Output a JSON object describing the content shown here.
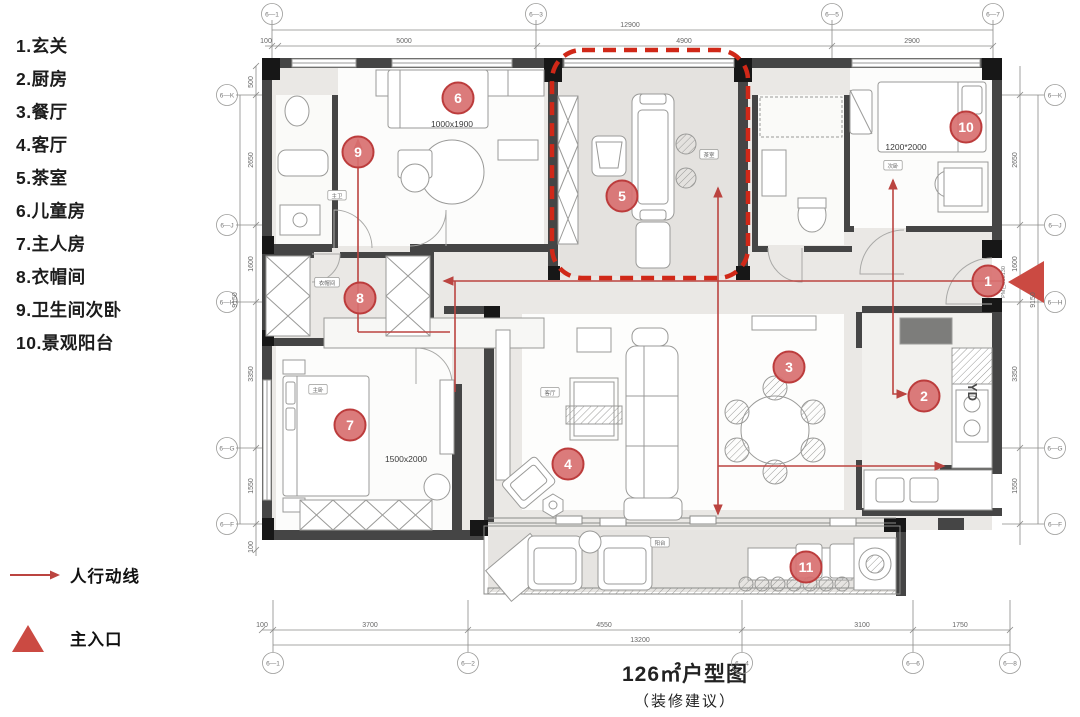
{
  "legend": {
    "items": [
      {
        "num": "1.",
        "label": "玄关"
      },
      {
        "num": "2.",
        "label": "厨房"
      },
      {
        "num": "3.",
        "label": "餐厅"
      },
      {
        "num": "4.",
        "label": "客厅"
      },
      {
        "num": "5.",
        "label": "茶室"
      },
      {
        "num": "6.",
        "label": "儿童房"
      },
      {
        "num": "7.",
        "label": "主人房"
      },
      {
        "num": "8.",
        "label": "衣帽间"
      },
      {
        "num": "9.",
        "label": "卫生间次卧"
      },
      {
        "num": "10.",
        "label": "景观阳台"
      }
    ]
  },
  "flow_legend": {
    "arrow_label": "人行动线",
    "entrance_label": "主入口"
  },
  "title": {
    "main": "126㎡户型图",
    "sub": "（装修建议）"
  },
  "plan": {
    "markers": [
      {
        "n": "1",
        "x": 988,
        "y": 281
      },
      {
        "n": "2",
        "x": 924,
        "y": 396
      },
      {
        "n": "3",
        "x": 789,
        "y": 367
      },
      {
        "n": "4",
        "x": 568,
        "y": 464
      },
      {
        "n": "5",
        "x": 622,
        "y": 196
      },
      {
        "n": "6",
        "x": 458,
        "y": 98
      },
      {
        "n": "7",
        "x": 350,
        "y": 425
      },
      {
        "n": "8",
        "x": 360,
        "y": 298
      },
      {
        "n": "9",
        "x": 358,
        "y": 152
      },
      {
        "n": "10",
        "x": 966,
        "y": 127
      },
      {
        "n": "11",
        "x": 806,
        "y": 567
      }
    ],
    "size_labels": [
      {
        "text": "1000x1900",
        "x": 452,
        "y": 127
      },
      {
        "text": "1200*2000",
        "x": 906,
        "y": 150
      },
      {
        "text": "1500x2000",
        "x": 406,
        "y": 462
      }
    ],
    "room_tags": [
      {
        "text": "主卫",
        "x": 337,
        "y": 197
      },
      {
        "text": "茶室",
        "x": 709,
        "y": 156
      },
      {
        "text": "次卧",
        "x": 893,
        "y": 167
      },
      {
        "text": "衣帽间",
        "x": 327,
        "y": 284
      },
      {
        "text": "主卧",
        "x": 318,
        "y": 391
      },
      {
        "text": "客厅",
        "x": 550,
        "y": 394
      },
      {
        "text": "阳台",
        "x": 660,
        "y": 544
      }
    ],
    "grid": {
      "top": [
        {
          "label": "6-1",
          "x": 272
        },
        {
          "label": "6-3",
          "x": 536
        },
        {
          "label": "6-5",
          "x": 832
        },
        {
          "label": "6-7",
          "x": 993
        }
      ],
      "bottom": [
        {
          "label": "6-1",
          "x": 273
        },
        {
          "label": "6-2",
          "x": 468
        },
        {
          "label": "6-4",
          "x": 742
        },
        {
          "label": "6-6",
          "x": 913
        },
        {
          "label": "6-8",
          "x": 1010
        }
      ],
      "left": [
        {
          "label": "6-K",
          "y": 95
        },
        {
          "label": "6-J",
          "y": 225
        },
        {
          "label": "6-H",
          "y": 302
        },
        {
          "label": "6-G",
          "y": 448
        },
        {
          "label": "6-F",
          "y": 524
        }
      ],
      "right": [
        {
          "label": "6-K",
          "y": 95
        },
        {
          "label": "6-J",
          "y": 225
        },
        {
          "label": "6-H",
          "y": 302
        },
        {
          "label": "6-G",
          "y": 448
        },
        {
          "label": "6-F",
          "y": 524
        }
      ]
    },
    "dims": {
      "top_total": {
        "text": "12900",
        "x": 630,
        "y": 27
      },
      "top_chain": [
        {
          "text": "100",
          "x": 266,
          "y": 43
        },
        {
          "text": "5000",
          "x": 404,
          "y": 43
        },
        {
          "text": "4900",
          "x": 684,
          "y": 43
        },
        {
          "text": "2900",
          "x": 912,
          "y": 43
        }
      ],
      "bottom_chain": [
        {
          "text": "100",
          "x": 262,
          "y": 627
        },
        {
          "text": "3700",
          "x": 370,
          "y": 627
        },
        {
          "text": "4550",
          "x": 604,
          "y": 627
        },
        {
          "text": "3100",
          "x": 862,
          "y": 627
        },
        {
          "text": "1750",
          "x": 960,
          "y": 627
        }
      ],
      "bottom_total": {
        "text": "13200",
        "x": 640,
        "y": 642
      },
      "left_chain": [
        {
          "text": "500",
          "y": 82
        },
        {
          "text": "2650",
          "y": 160
        },
        {
          "text": "1600",
          "y": 264
        },
        {
          "text": "3350",
          "y": 374
        },
        {
          "text": "1550",
          "y": 486
        },
        {
          "text": "100",
          "y": 547
        }
      ],
      "left_total": {
        "text": "9150",
        "y": 300
      },
      "right_chain": [
        {
          "text": "2650",
          "y": 160
        },
        {
          "text": "1600",
          "y": 264
        },
        {
          "text": "3350",
          "y": 374
        },
        {
          "text": "1550",
          "y": 486
        }
      ],
      "right_total": {
        "text": "9150",
        "y": 300
      }
    },
    "annotations": {
      "yd": "YD",
      "door_code": "PM乙J05130"
    },
    "colors": {
      "accent_red": "#c84b43",
      "marker_fill": "#d87070",
      "marker_stroke": "#bc3c3c",
      "dash_red": "#d02818",
      "wall": "#454545"
    }
  }
}
